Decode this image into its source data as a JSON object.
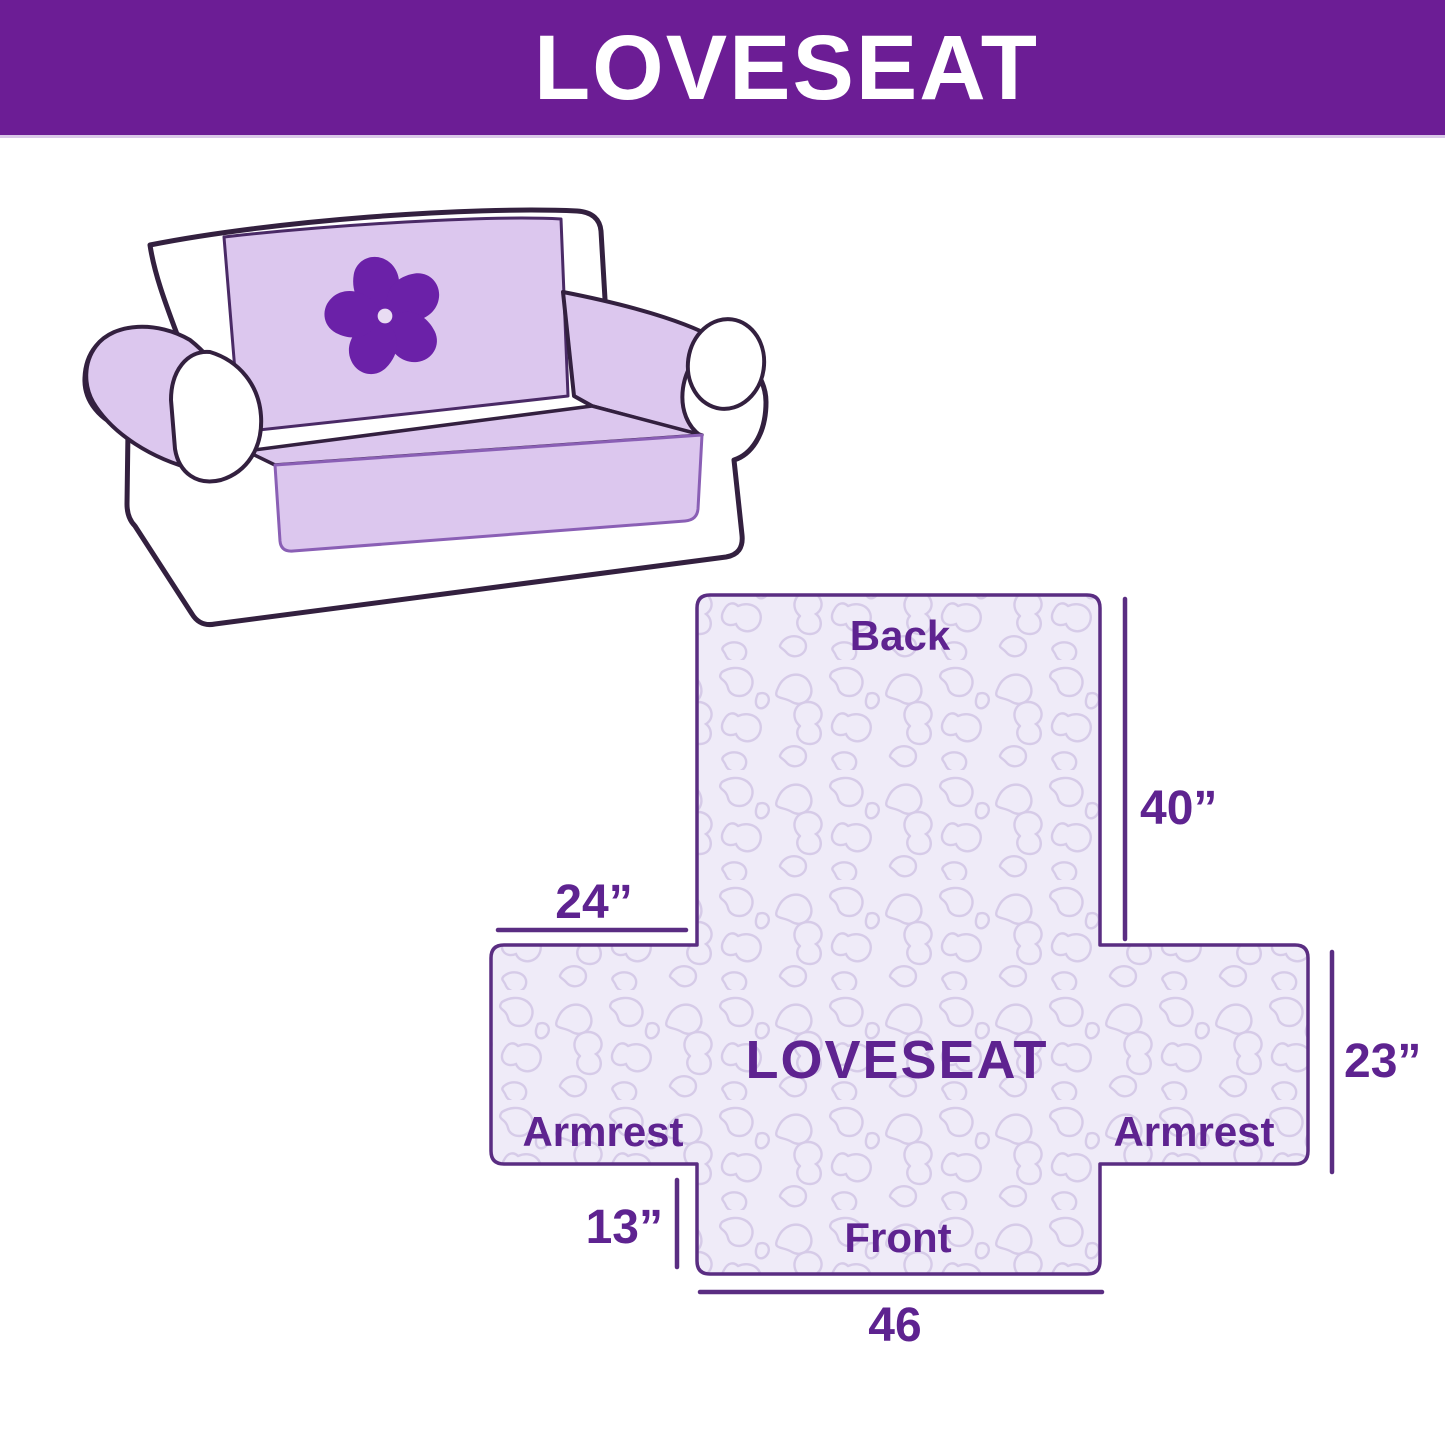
{
  "header": {
    "title": "LOVESEAT"
  },
  "illustration": {
    "alt": "loveseat sofa with quilted lavender protector cover",
    "logo_icon": "pinwheel-flower-icon"
  },
  "diagram": {
    "center_label": "LOVESEAT",
    "back_label": "Back",
    "front_label": "Front",
    "armrest_left_label": "Armrest",
    "armrest_right_label": "Armrest",
    "dim_back_height": "40”",
    "dim_back_width": "24”",
    "dim_side_height": "23”",
    "dim_front_drop": "13”",
    "dim_front_width": "46"
  },
  "colors": {
    "header_bg": "#6C1D95",
    "header_text": "#FFFFFF",
    "accent_text": "#5E2390",
    "sofa_outline": "#33203F",
    "cover_lavender": "#DCC7EE",
    "cover_edge": "#8A5FB5",
    "logo_purple": "#6B21A8",
    "diagram_fill": "#EFEBF8",
    "diagram_border": "#5A2D82",
    "squiggle": "#D6CBE8"
  }
}
